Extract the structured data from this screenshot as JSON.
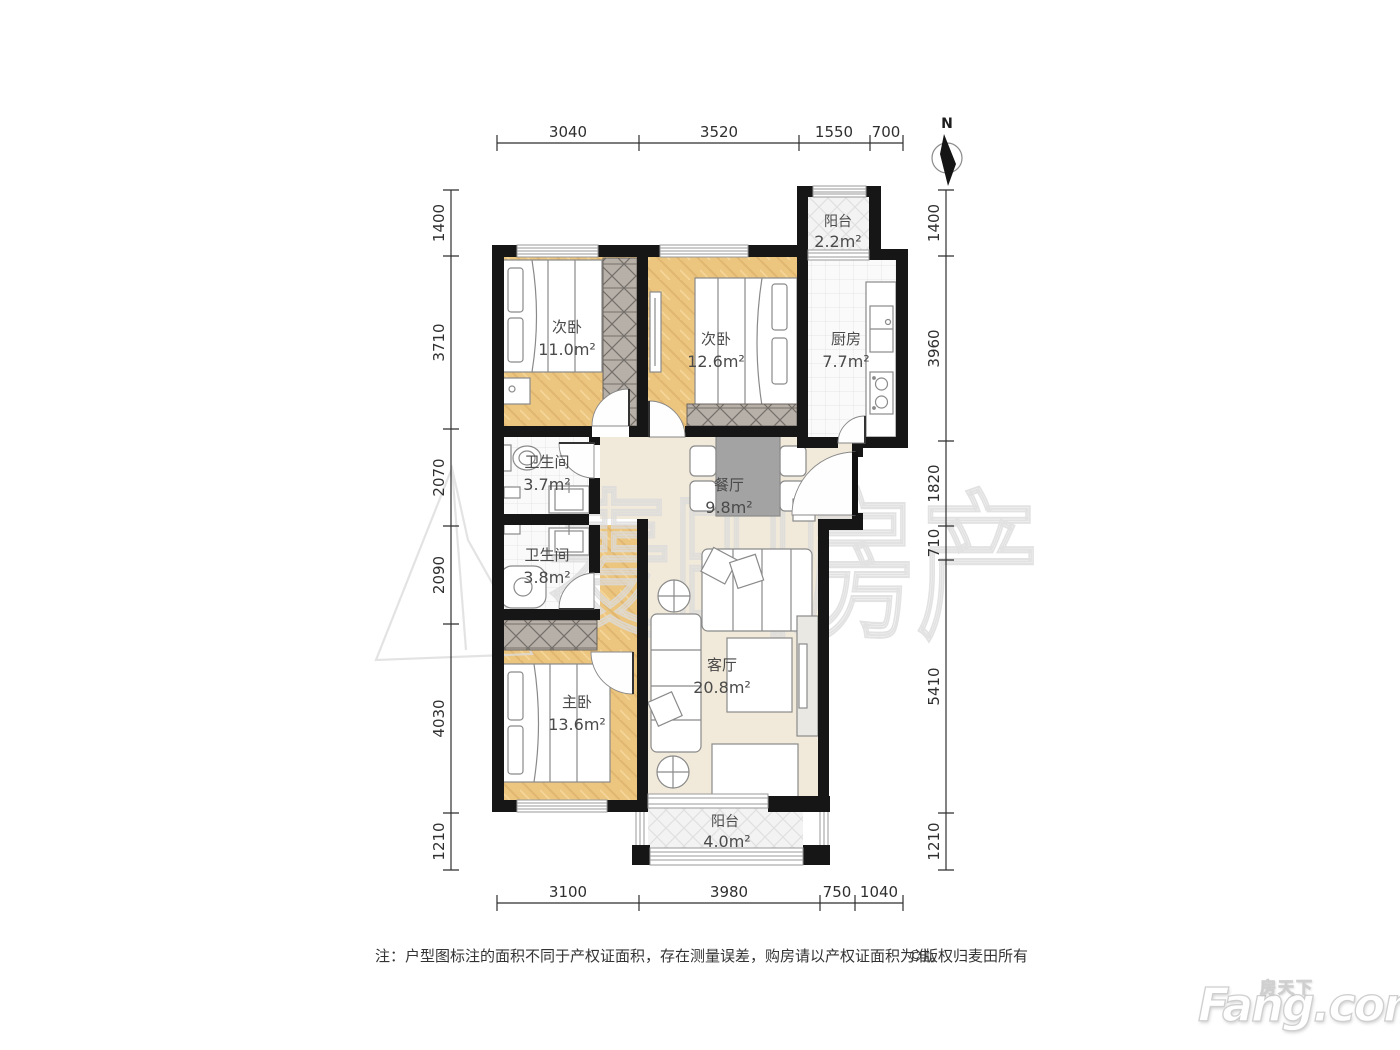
{
  "compass": {
    "label": "N"
  },
  "rooms": {
    "balcony_top": {
      "name": "阳台",
      "area": "2.2m²"
    },
    "bedroom_a": {
      "name": "次卧",
      "area": "11.0m²"
    },
    "bedroom_b": {
      "name": "次卧",
      "area": "12.6m²"
    },
    "kitchen": {
      "name": "厨房",
      "area": "7.7m²"
    },
    "bath_a": {
      "name": "卫生间",
      "area": "3.7m²"
    },
    "dining": {
      "name": "餐厅",
      "area": "9.8m²"
    },
    "bath_b": {
      "name": "卫生间",
      "area": "3.8m²"
    },
    "master": {
      "name": "主卧",
      "area": "13.6m²"
    },
    "living": {
      "name": "客厅",
      "area": "20.8m²"
    },
    "balcony_bottom": {
      "name": "阳台",
      "area": "4.0m²"
    }
  },
  "dimensions": {
    "top": [
      "3040",
      "3520",
      "1550",
      "700"
    ],
    "bottom": [
      "3100",
      "3980",
      "750",
      "1040"
    ],
    "left": [
      "1400",
      "3710",
      "2070",
      "2090",
      "4030",
      "1210"
    ],
    "right": [
      "1400",
      "3960",
      "1820",
      "710",
      "5410",
      "1210"
    ]
  },
  "note": {
    "text": "注：户型图标注的面积不同于产权证面积，存在测量误差，购房请以产权证面积为准。",
    "copyright": "©版权归麦田所有"
  },
  "watermark": {
    "center": "麦田房产",
    "brand_cn": "房天下",
    "brand": "Fang.com"
  }
}
